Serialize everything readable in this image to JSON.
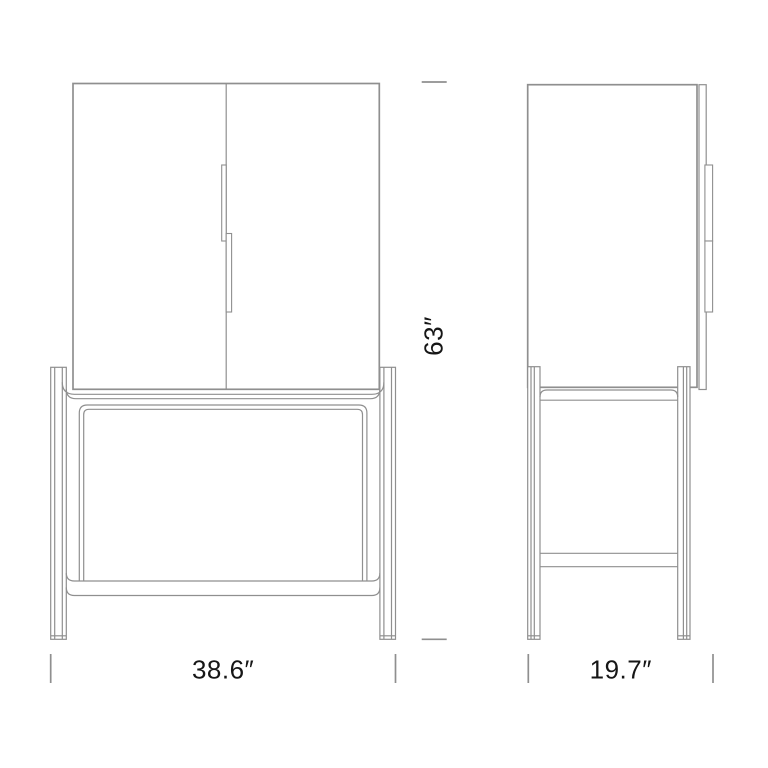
{
  "dimensions": {
    "height": {
      "value": 63,
      "unit": "in",
      "label": "63″"
    },
    "width": {
      "value": 38.6,
      "unit": "in",
      "label": "38.6″"
    },
    "depth": {
      "value": 19.7,
      "unit": "in",
      "label": "19.7″"
    }
  },
  "colors": {
    "line": "#8f8f8f",
    "text": "#161616",
    "background": "#ffffff"
  }
}
